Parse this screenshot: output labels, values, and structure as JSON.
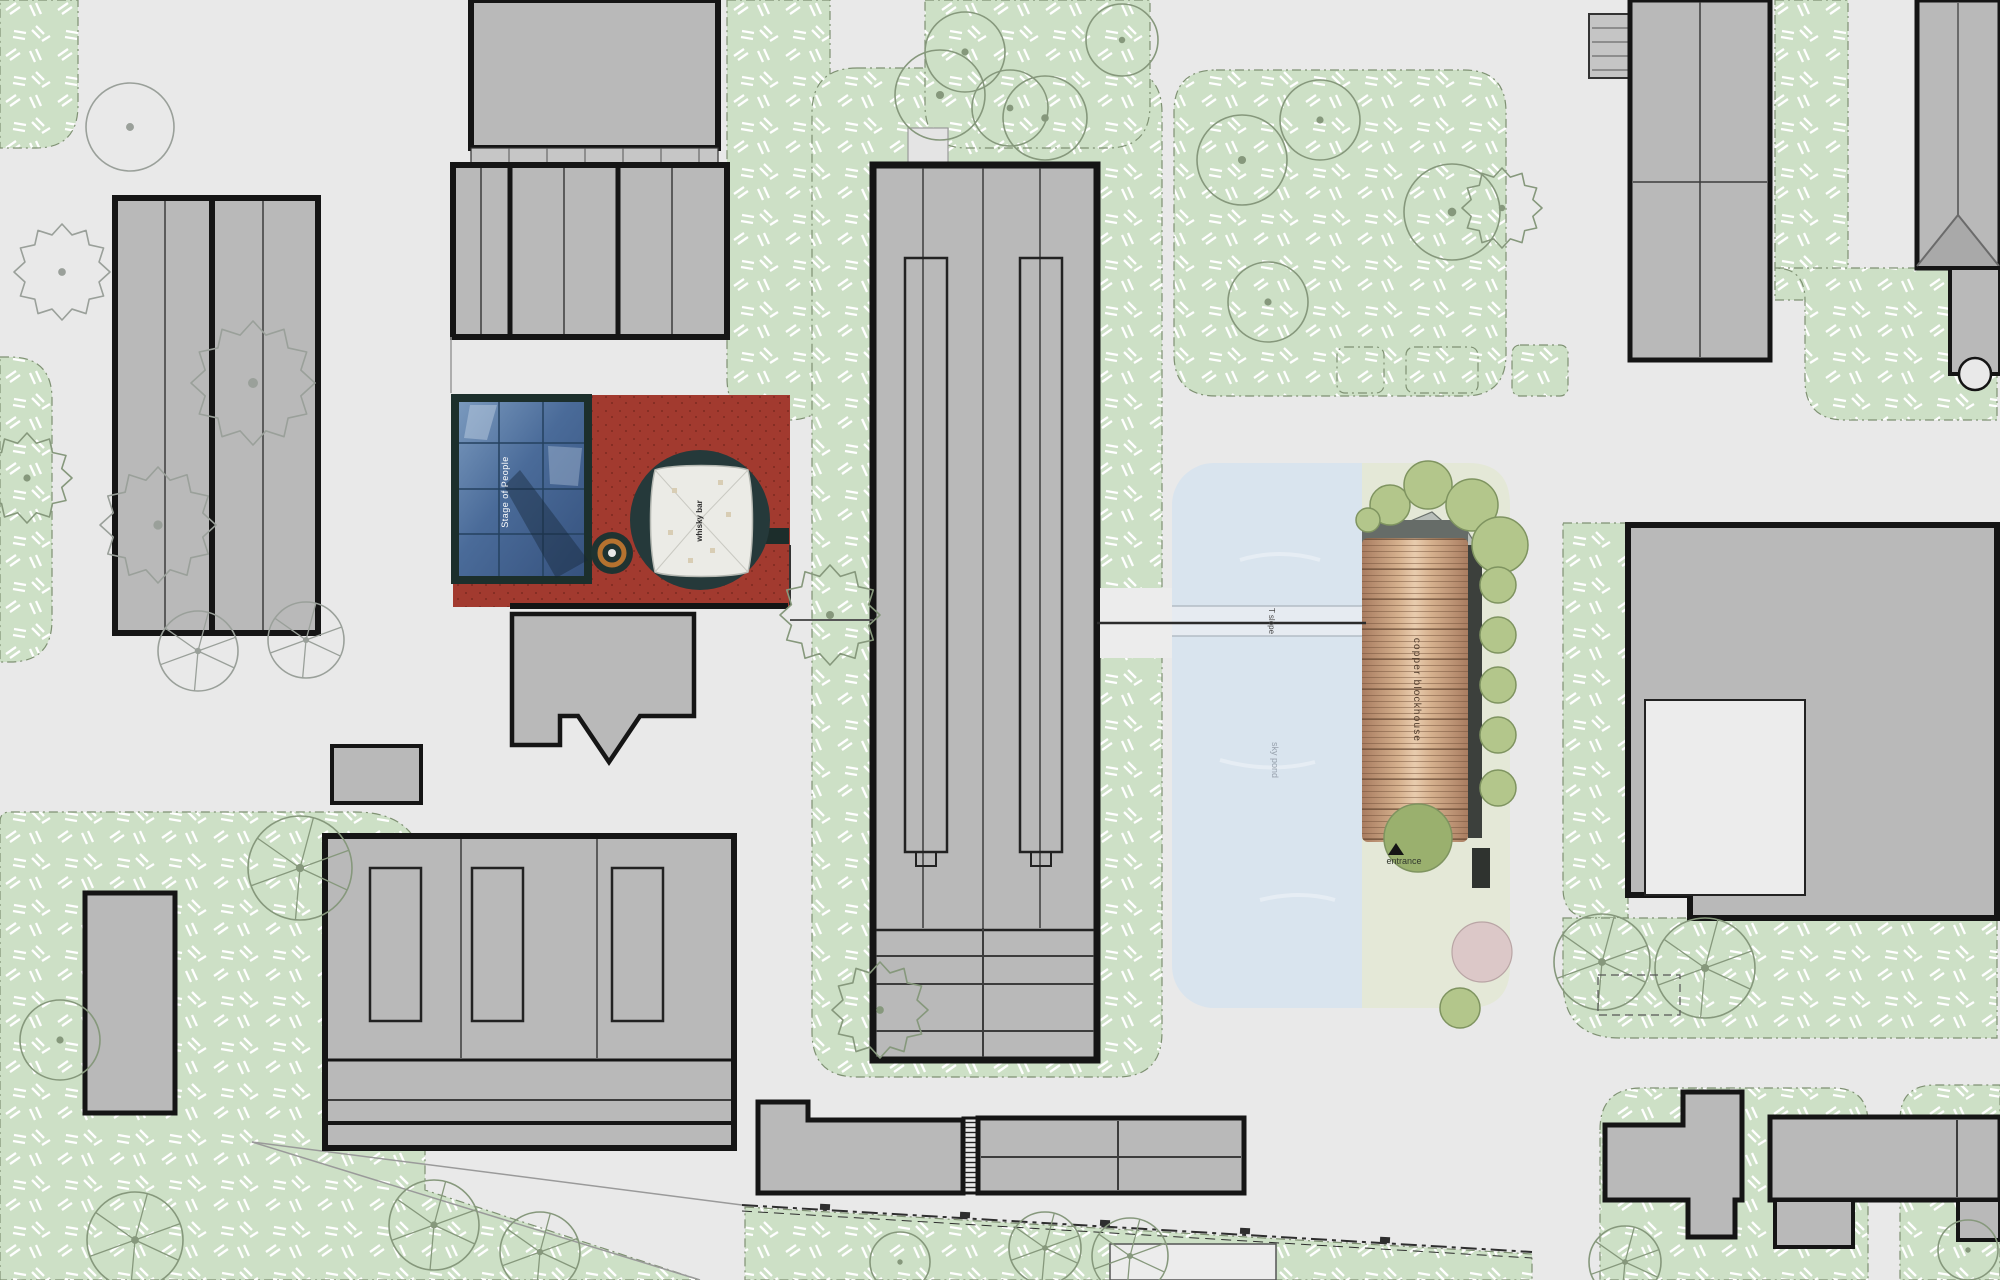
{
  "site_plan": {
    "labels": {
      "stage_of_people": "Stage of People",
      "whisky_bar": "whisky bar",
      "t_slope": "T slope",
      "sky_pond": "sky pond",
      "copper_blockhouse": "copper blockhouse",
      "entrance": "entrance"
    },
    "colors": {
      "background": "#e9e9e9",
      "grass_green": "#cde0c6",
      "grass_dash": "#ffffff",
      "building_gray": "#b9b9b9",
      "outline_black": "#151515",
      "plaza_red": "#a23a2f",
      "dark_teal": "#25393a",
      "stage_blue": "#4a6b99",
      "tent_white": "#ebebe6",
      "pond_blue": "#d9e4ee",
      "garden_strip": "#e4e8d7",
      "copper": "#c9a183",
      "tree_olive": "#b3c68b"
    }
  }
}
